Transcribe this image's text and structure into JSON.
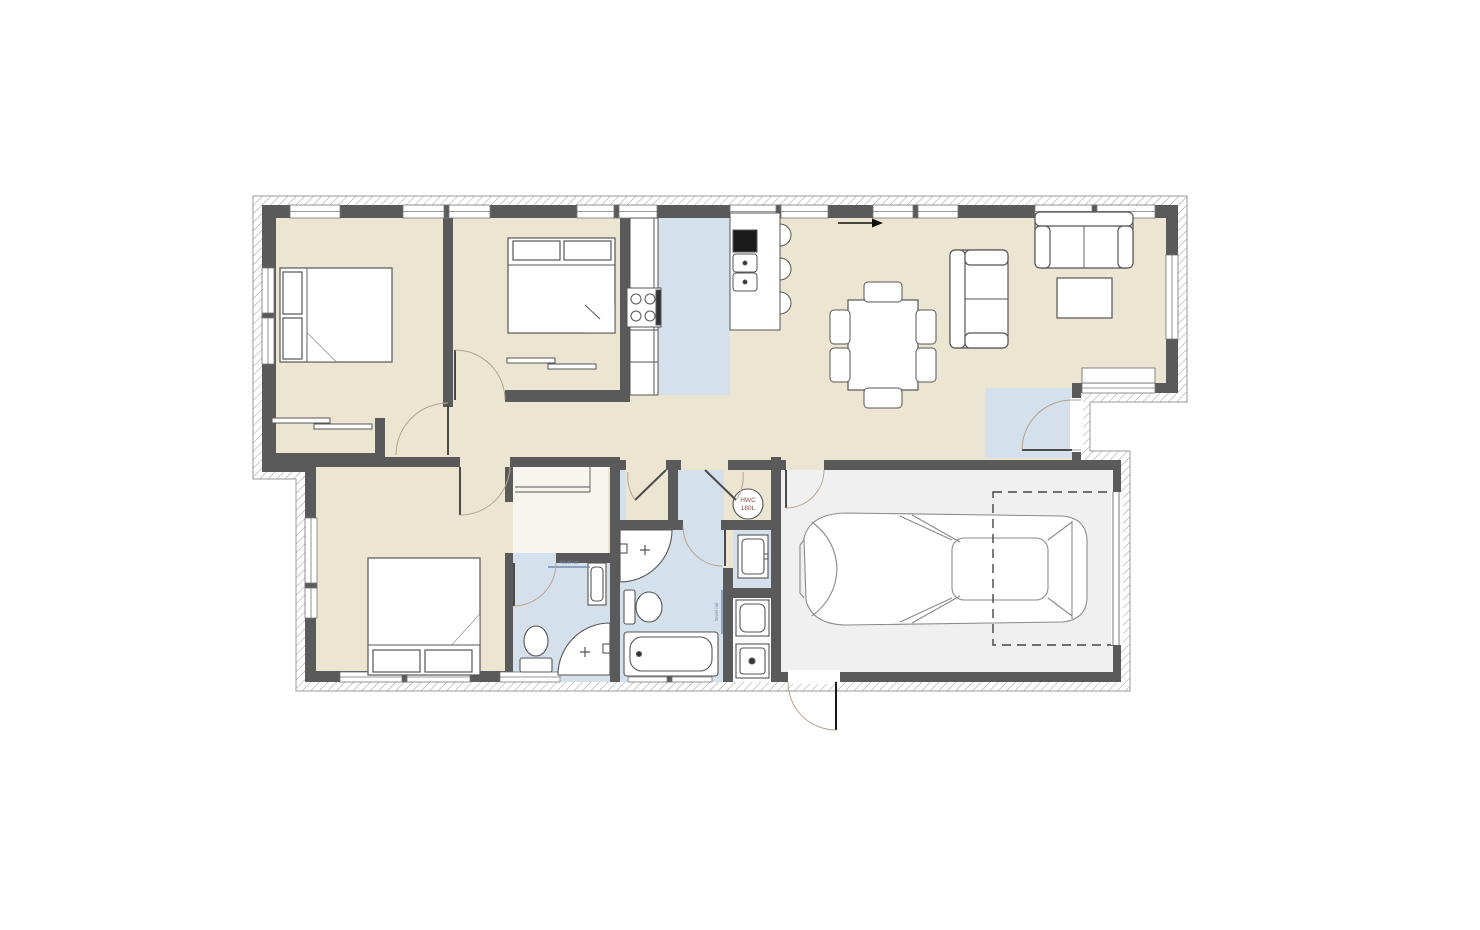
{
  "labels": {
    "hwc_line1": "HWC",
    "hwc_line2": "180L",
    "ensuite_towel_rail": "Towel rail",
    "bathroom_towel_rail": "Towel rail"
  },
  "colors": {
    "floor_beige": "#EBE5D1",
    "wet_area_blue": "#D4E0EB",
    "garage_grey": "#F0F0F0",
    "wall_grey": "#5A5A5A",
    "cladding_line": "#9A9A9A",
    "fixture_outline": "#555555",
    "door_arc": "#B3A58C",
    "hwc_text": "#8A4A42",
    "towel_text": "#7A8BB0"
  }
}
